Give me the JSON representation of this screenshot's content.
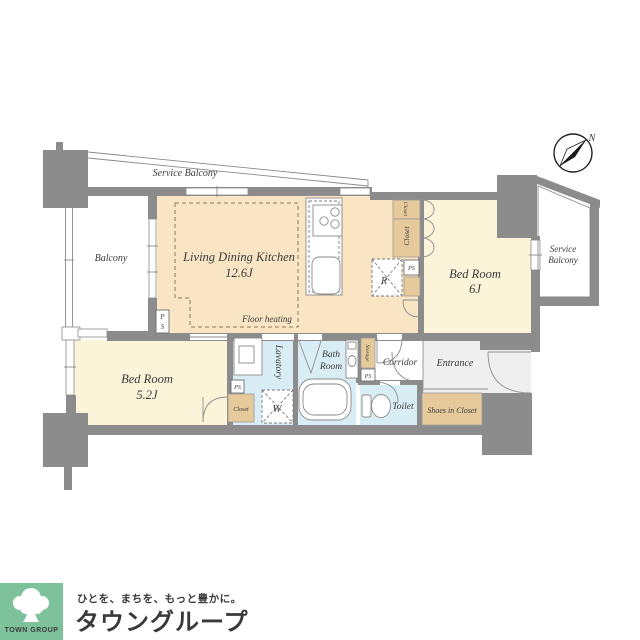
{
  "plan": {
    "labels": {
      "service_balcony_top": "Service Balcony",
      "balcony": "Balcony",
      "ldk_name": "Living Dining Kitchen",
      "ldk_size": "12.6J",
      "floor_heating": "Floor heating",
      "bedroom1_name": "Bed Room",
      "bedroom1_size": "6J",
      "service_balcony_right_line1": "Service",
      "service_balcony_right_line2": "Balcony",
      "bedroom2_name": "Bed Room",
      "bedroom2_size": "5.2J",
      "lavatory": "Lavatory",
      "bath_line1": "Bath",
      "bath_line2": "Room",
      "corridor": "Corridor",
      "entrance": "Entrance",
      "toilet": "Toilet",
      "shoes_in_closet": "Shoes in Closet",
      "closet_top": "Closet",
      "closet_mid": "Closet",
      "closet_bedroom2": "Closet",
      "storage": "Storage",
      "refrigerator": "R",
      "washer": "W",
      "ps": "PS",
      "ps_stack": [
        "P",
        "S"
      ],
      "compass_north": "N"
    },
    "colors": {
      "wall": "#8C8C8C",
      "ldk": "#F9E4C4",
      "bedroom": "#FCF4D8",
      "closet": "#E6CA9B",
      "wet": "#D9EEF4",
      "entrance": "#EFEFEF"
    }
  },
  "footer": {
    "logo_text": "TOWN GROUP",
    "logo_bg": "#7EC29C",
    "tagline": "ひとを、まちを、もっと豊かに。",
    "brand": "タウングループ",
    "brand_color": "#6CBD92"
  }
}
